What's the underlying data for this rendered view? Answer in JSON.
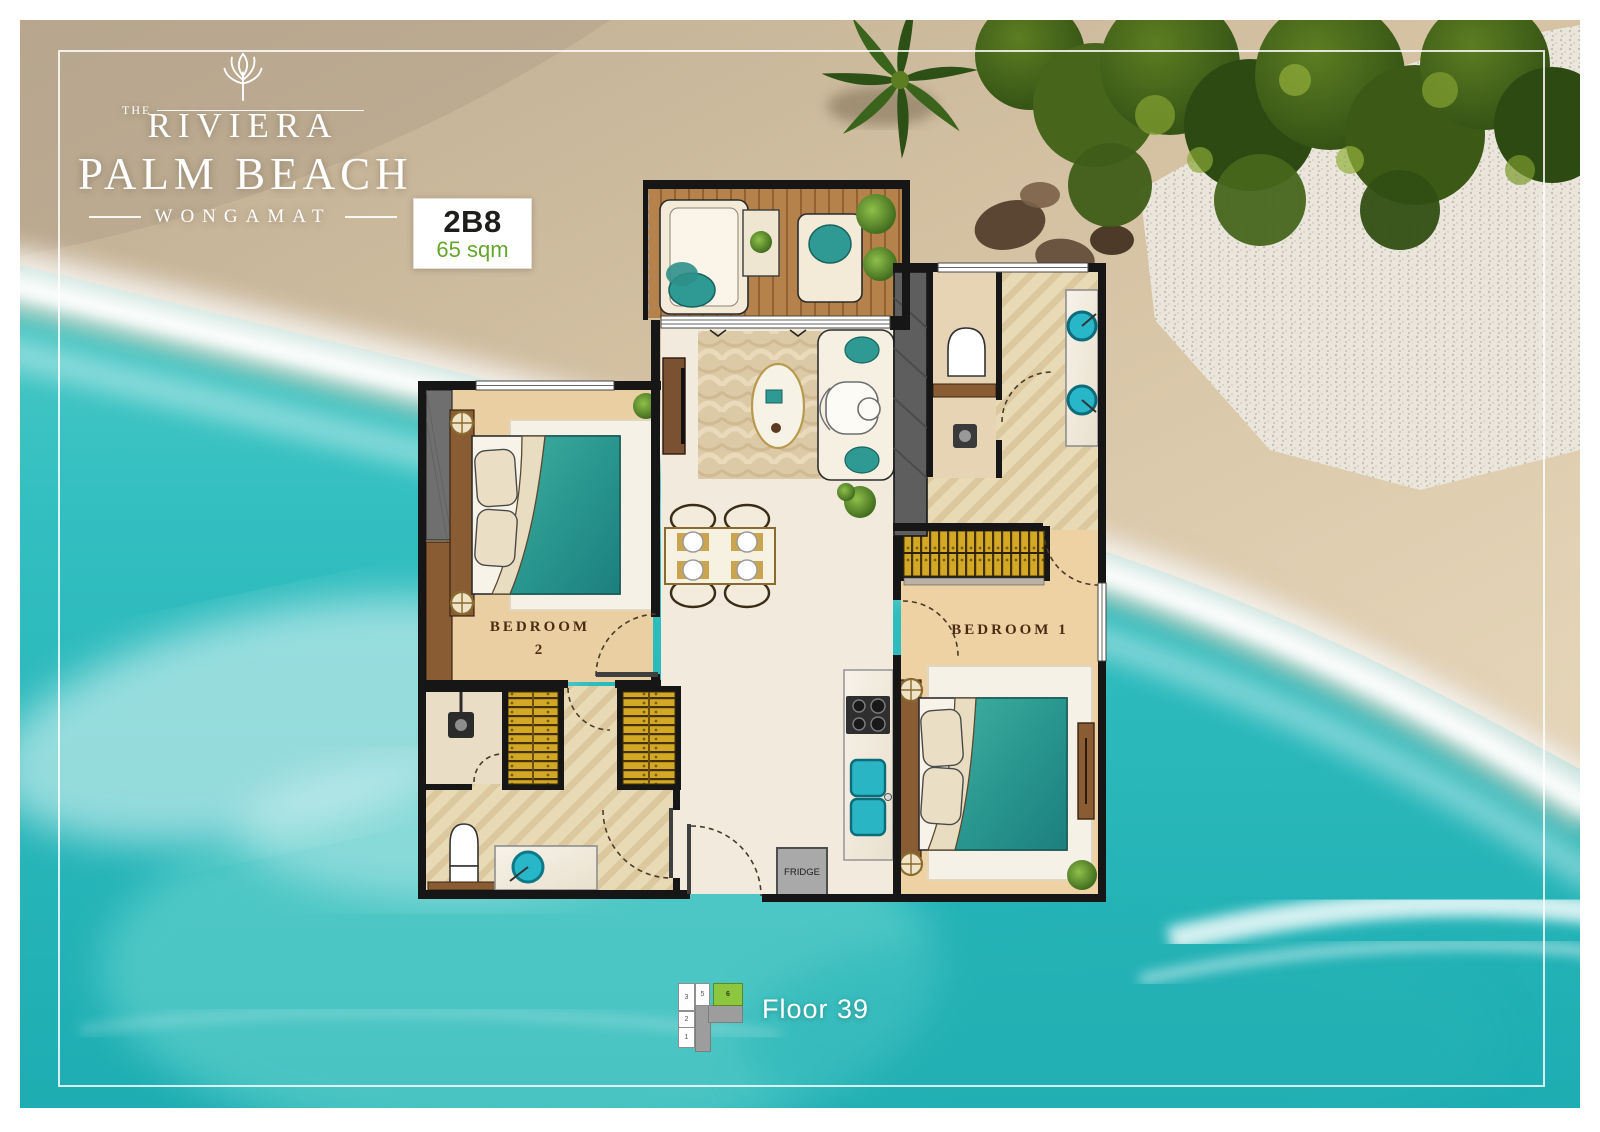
{
  "brand": {
    "the": "THE",
    "name": "RIVIERA",
    "title": "PALM BEACH",
    "location": "WONGAMAT"
  },
  "unit_badge": {
    "code": "2B8",
    "area": "65 sqm"
  },
  "floor_plan": {
    "bedroom2_line1": "BEDROOM",
    "bedroom2_line2": "2",
    "bedroom1": "BEDROOM 1",
    "fridge": "FRIDGE"
  },
  "floor_key": {
    "label": "Floor 39",
    "highlighted_unit": "6",
    "units": [
      {
        "label": "3"
      },
      {
        "label": "5"
      },
      {
        "label": "6"
      },
      {
        "label": "2"
      },
      {
        "label": "1"
      }
    ]
  },
  "colors": {
    "water_teal": "#2fbcbd",
    "sand": "#d8c5a7",
    "badge_green": "#64a62c",
    "key_highlight_green": "#8dc63f",
    "duvet_teal": "#2f9f98",
    "wardrobe_gold": "#d2a825",
    "wall_black": "#161616"
  }
}
